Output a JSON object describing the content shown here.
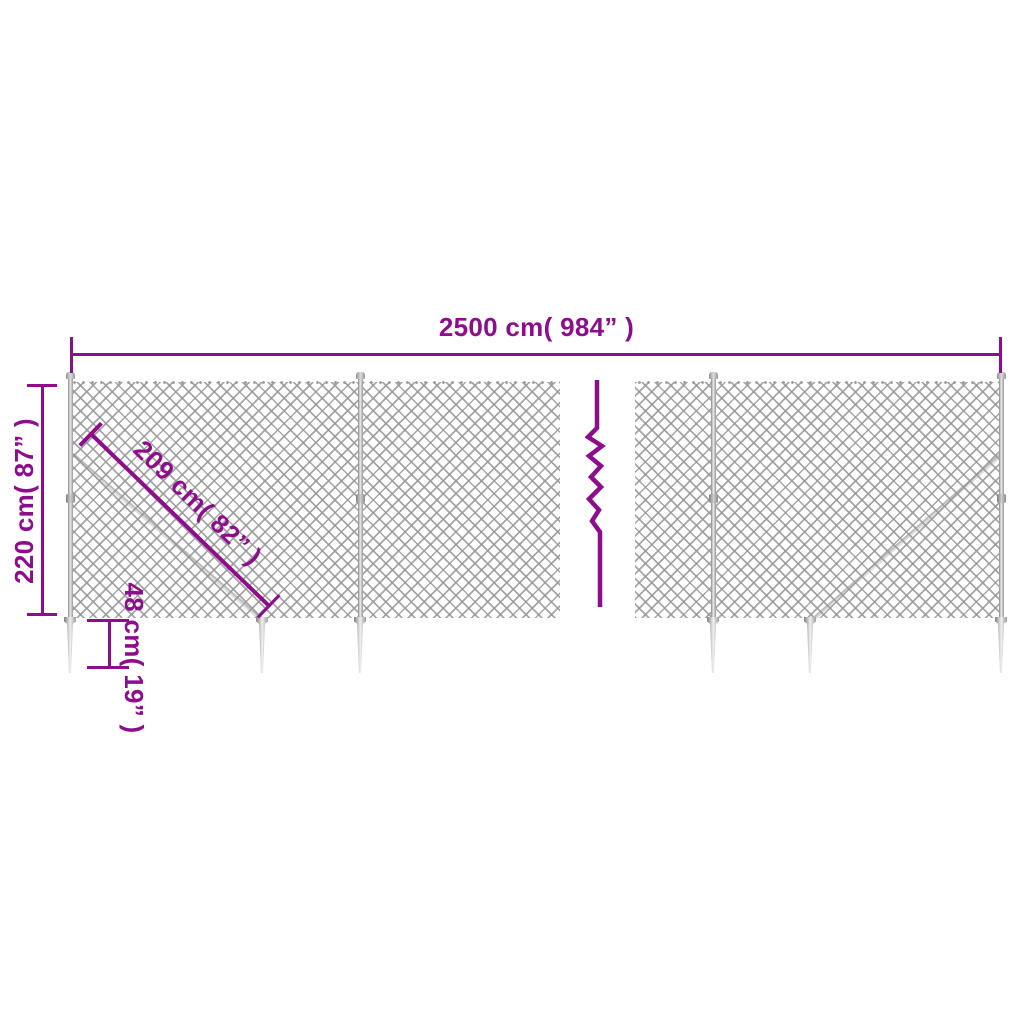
{
  "diagram": {
    "type": "product-dimension-diagram",
    "subject": "chain-link fence with posts and spike ground anchors",
    "accent_color": "#8E0D8C",
    "mesh_color": "#969696",
    "hardware_color": "#9a9a9a",
    "labels": {
      "width": "2500 cm( 984” )",
      "height": "220 cm( 87” )",
      "diagonal": "209 cm( 82” )",
      "anchor": "48 cm( 19” )"
    },
    "symbols": {
      "break_symbol": "zigzag-break-icon"
    }
  }
}
